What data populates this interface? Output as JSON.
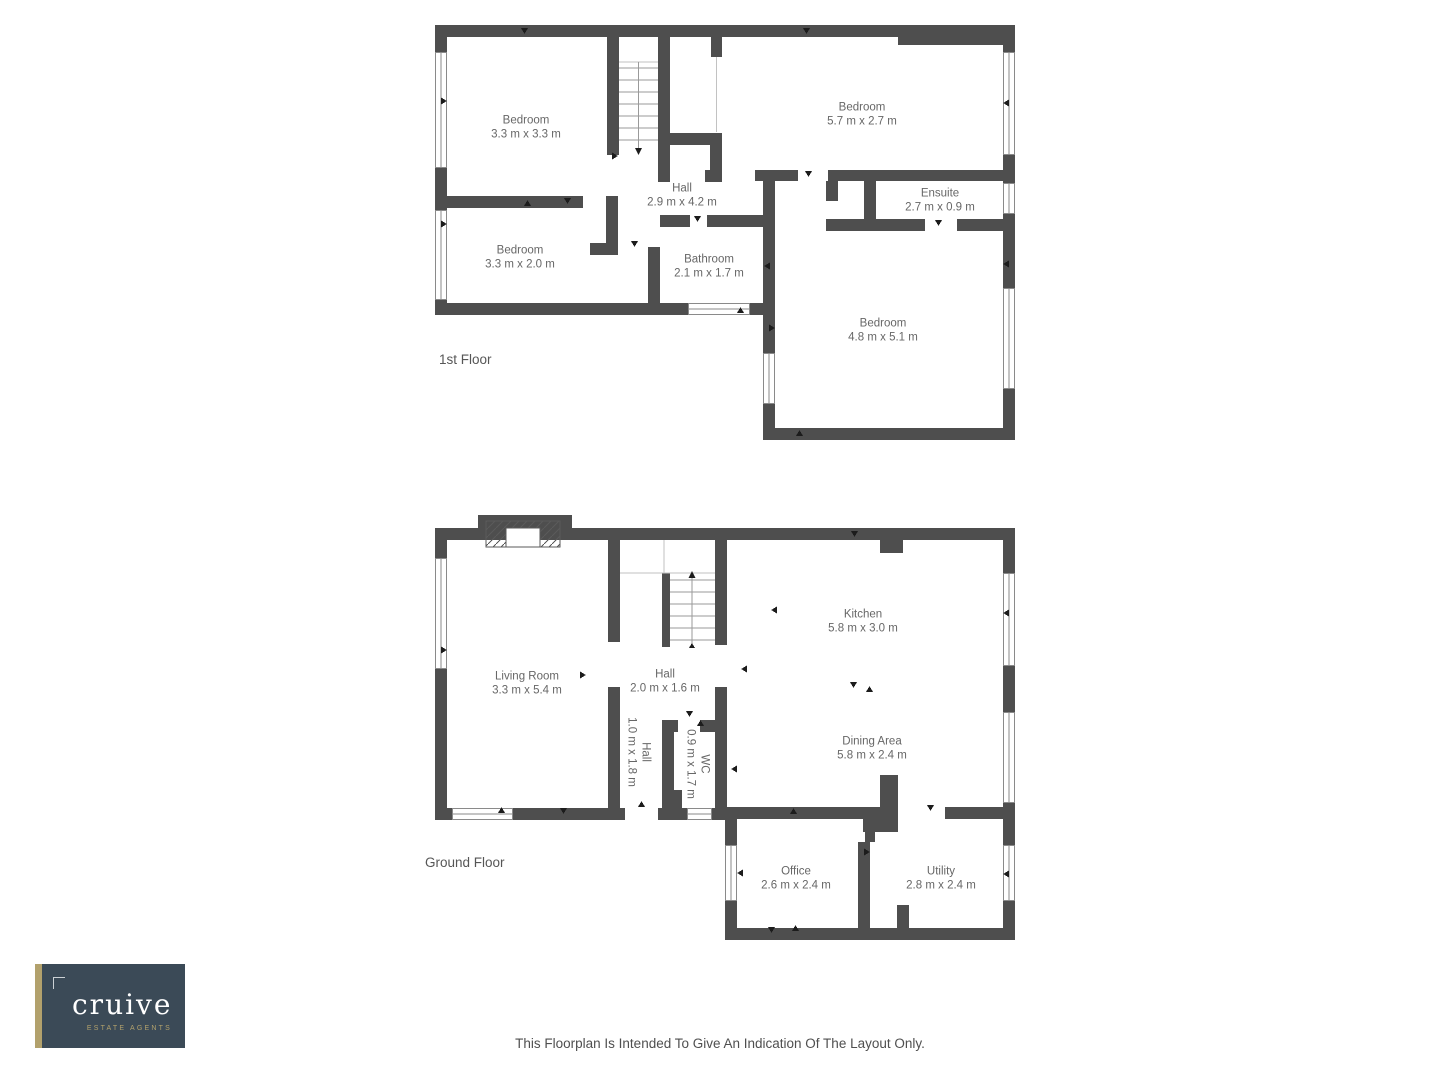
{
  "page": {
    "disclaimer": "This Floorplan Is Intended To Give An Indication Of The Layout Only."
  },
  "colors": {
    "wall": "#4e4e4e",
    "label_text": "#676767",
    "logo_background": "#3b4a57",
    "logo_accent": "#b2a16c",
    "logo_text": "#ffffff"
  },
  "first_floor": {
    "title": "1st Floor",
    "rooms": [
      {
        "name": "Bedroom",
        "dims": "3.3 m x 3.3 m"
      },
      {
        "name": "Bedroom",
        "dims": "5.7 m x 2.7 m"
      },
      {
        "name": "Hall",
        "dims": "2.9 m x 4.2 m"
      },
      {
        "name": "Ensuite",
        "dims": "2.7 m x 0.9 m"
      },
      {
        "name": "Bedroom",
        "dims": "3.3 m x 2.0 m"
      },
      {
        "name": "Bathroom",
        "dims": "2.1 m x 1.7 m"
      },
      {
        "name": "Bedroom",
        "dims": "4.8 m x 5.1 m"
      }
    ]
  },
  "ground_floor": {
    "title": "Ground Floor",
    "rooms": [
      {
        "name": "Living Room",
        "dims": "3.3 m x 5.4 m"
      },
      {
        "name": "Hall",
        "dims": "2.0 m x 1.6 m"
      },
      {
        "name": "Kitchen",
        "dims": "5.8 m x 3.0 m"
      },
      {
        "name": "Dining Area",
        "dims": "5.8 m x 2.4 m"
      },
      {
        "name": "Hall",
        "dims": "1.0 m x 1.8 m"
      },
      {
        "name": "WC",
        "dims": "0.9 m x 1.7 m"
      },
      {
        "name": "Office",
        "dims": "2.6 m x 2.4 m"
      },
      {
        "name": "Utility",
        "dims": "2.8 m x 2.4 m"
      }
    ]
  },
  "logo": {
    "brand": "cruive",
    "tagline": "ESTATE AGENTS"
  }
}
